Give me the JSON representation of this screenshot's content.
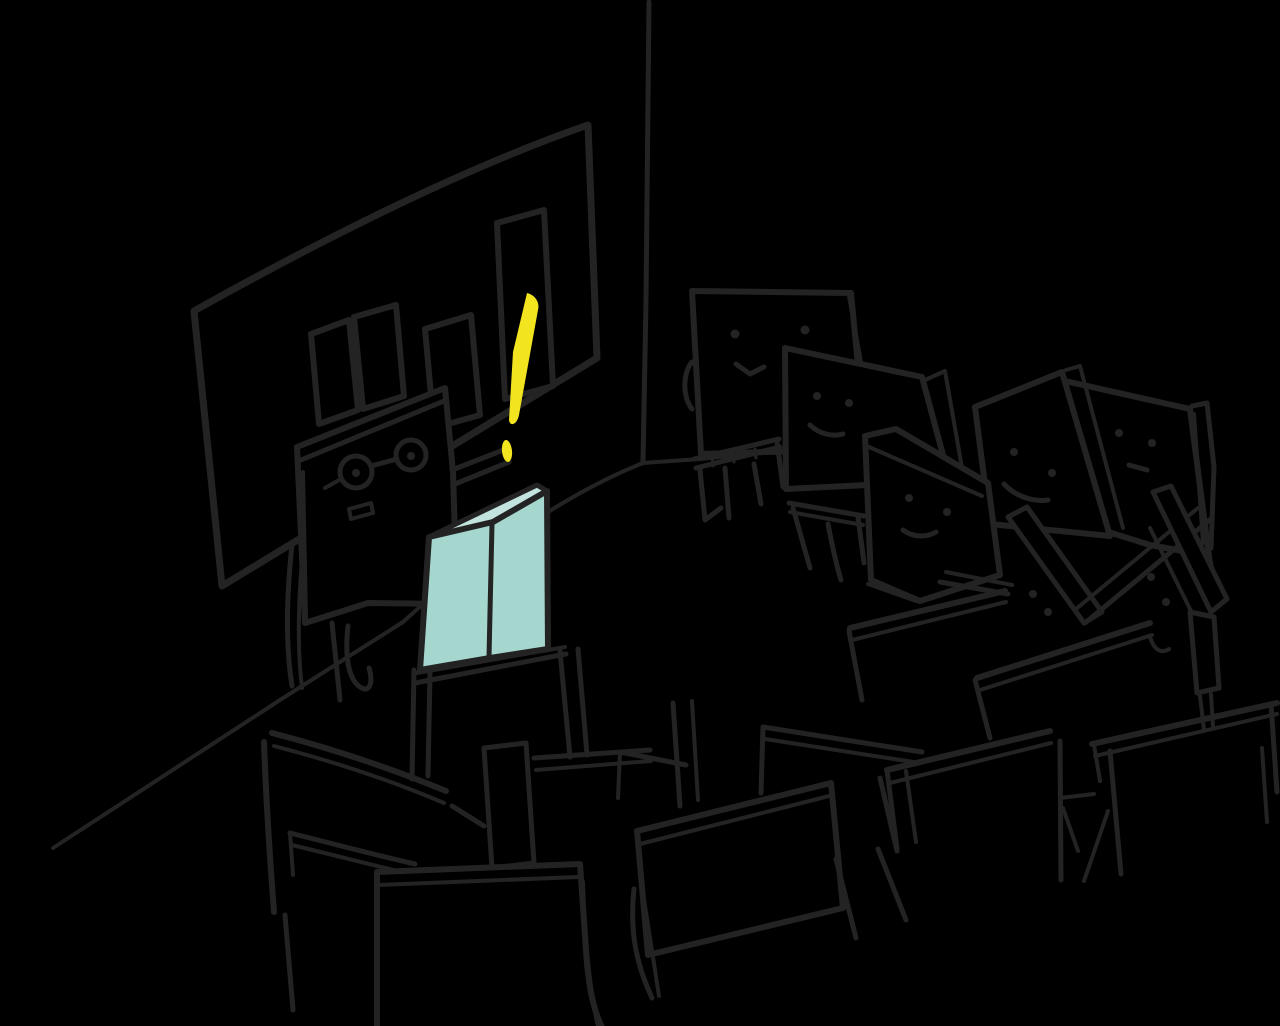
{
  "canvas": {
    "width": 1280,
    "height": 1026
  },
  "colors": {
    "background": "#000000",
    "ink": "#232323",
    "podium_front": "#a6d7cf",
    "podium_top": "#c3e4de",
    "highlight_yellow": "#f2e41f"
  },
  "scene": {
    "type": "hand-drawn sketch illustration",
    "setting": "classroom with presenter and audience",
    "objects": [
      "room corner and floor lines",
      "whiteboard with four bar-chart bars",
      "square-headed teacher wearing round glasses",
      "yellow exclamation mark",
      "teal lectern with stand",
      "student back-row-left with smile",
      "student back-row-middle with smile",
      "student middle-row with pentagon head",
      "student right-row tilted head",
      "tall student far-right",
      "student front-right peeking behind chair",
      "rows of sketched chairs and desks"
    ]
  }
}
